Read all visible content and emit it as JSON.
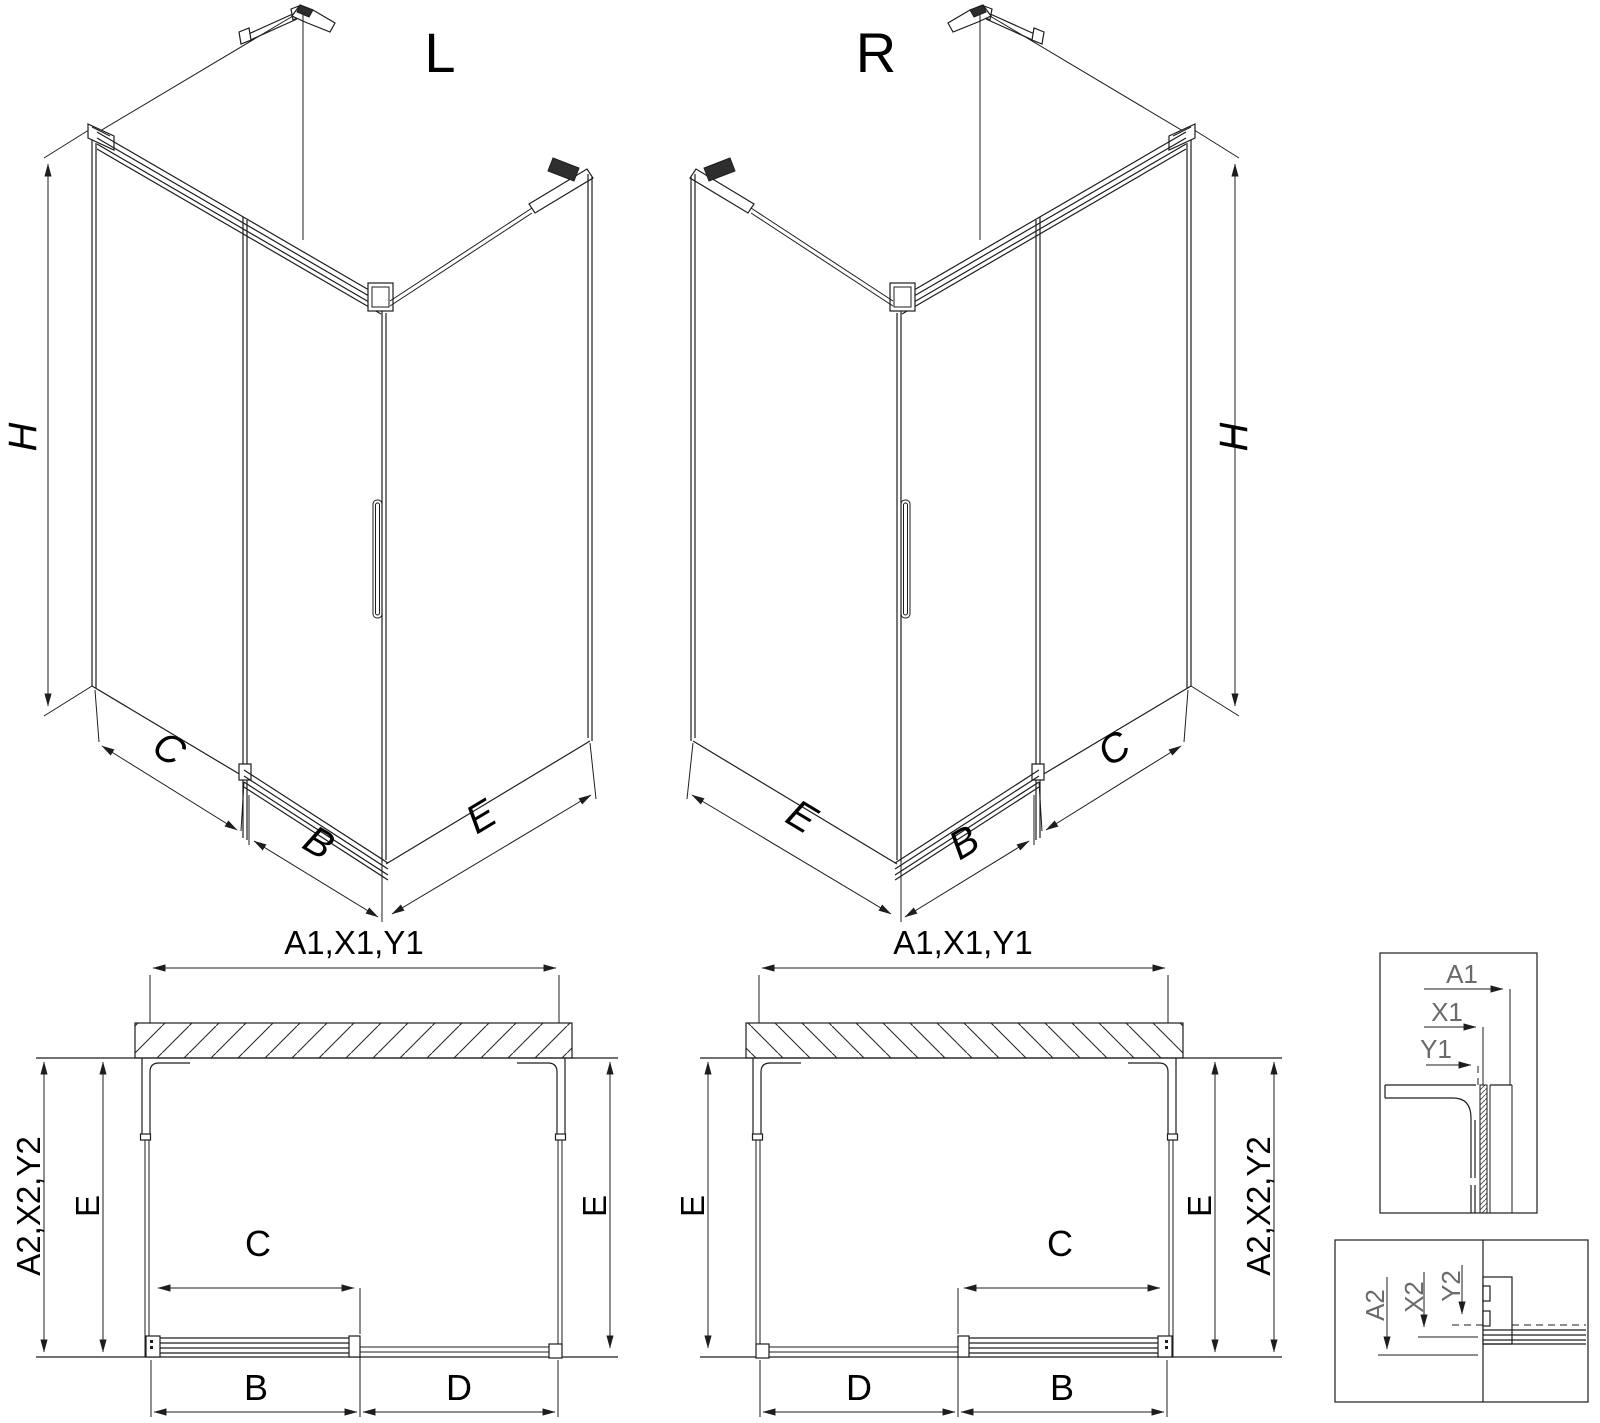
{
  "colors": {
    "line": "#1d1d1d",
    "text": "#000000",
    "detail_text": "#6a6a6a",
    "background": "#ffffff"
  },
  "iso_left": {
    "title": "L",
    "dim_height": "H",
    "dim_back_width": "C",
    "dim_door_width": "B",
    "dim_side_width": "E"
  },
  "iso_right": {
    "title": "R",
    "dim_height": "H",
    "dim_back_width": "C",
    "dim_door_width": "B",
    "dim_side_width": "E"
  },
  "plan_left": {
    "dim_total_width": "A1,X1,Y1",
    "dim_total_depth": "A2,X2,Y2",
    "dim_depth_inner": "E",
    "dim_depth_right": "E",
    "dim_opening": "C",
    "dim_door": "B",
    "dim_fixed": "D"
  },
  "plan_right": {
    "dim_total_width": "A1,X1,Y1",
    "dim_depth_left": "E",
    "dim_depth_inner": "E",
    "dim_total_depth": "A2,X2,Y2",
    "dim_opening": "C",
    "dim_fixed": "D",
    "dim_door": "B"
  },
  "detail_top_right": {
    "dim_a": "A1",
    "dim_x": "X1",
    "dim_y": "Y1"
  },
  "detail_bottom_right": {
    "dim_a": "A2",
    "dim_x": "X2",
    "dim_y": "Y2"
  }
}
